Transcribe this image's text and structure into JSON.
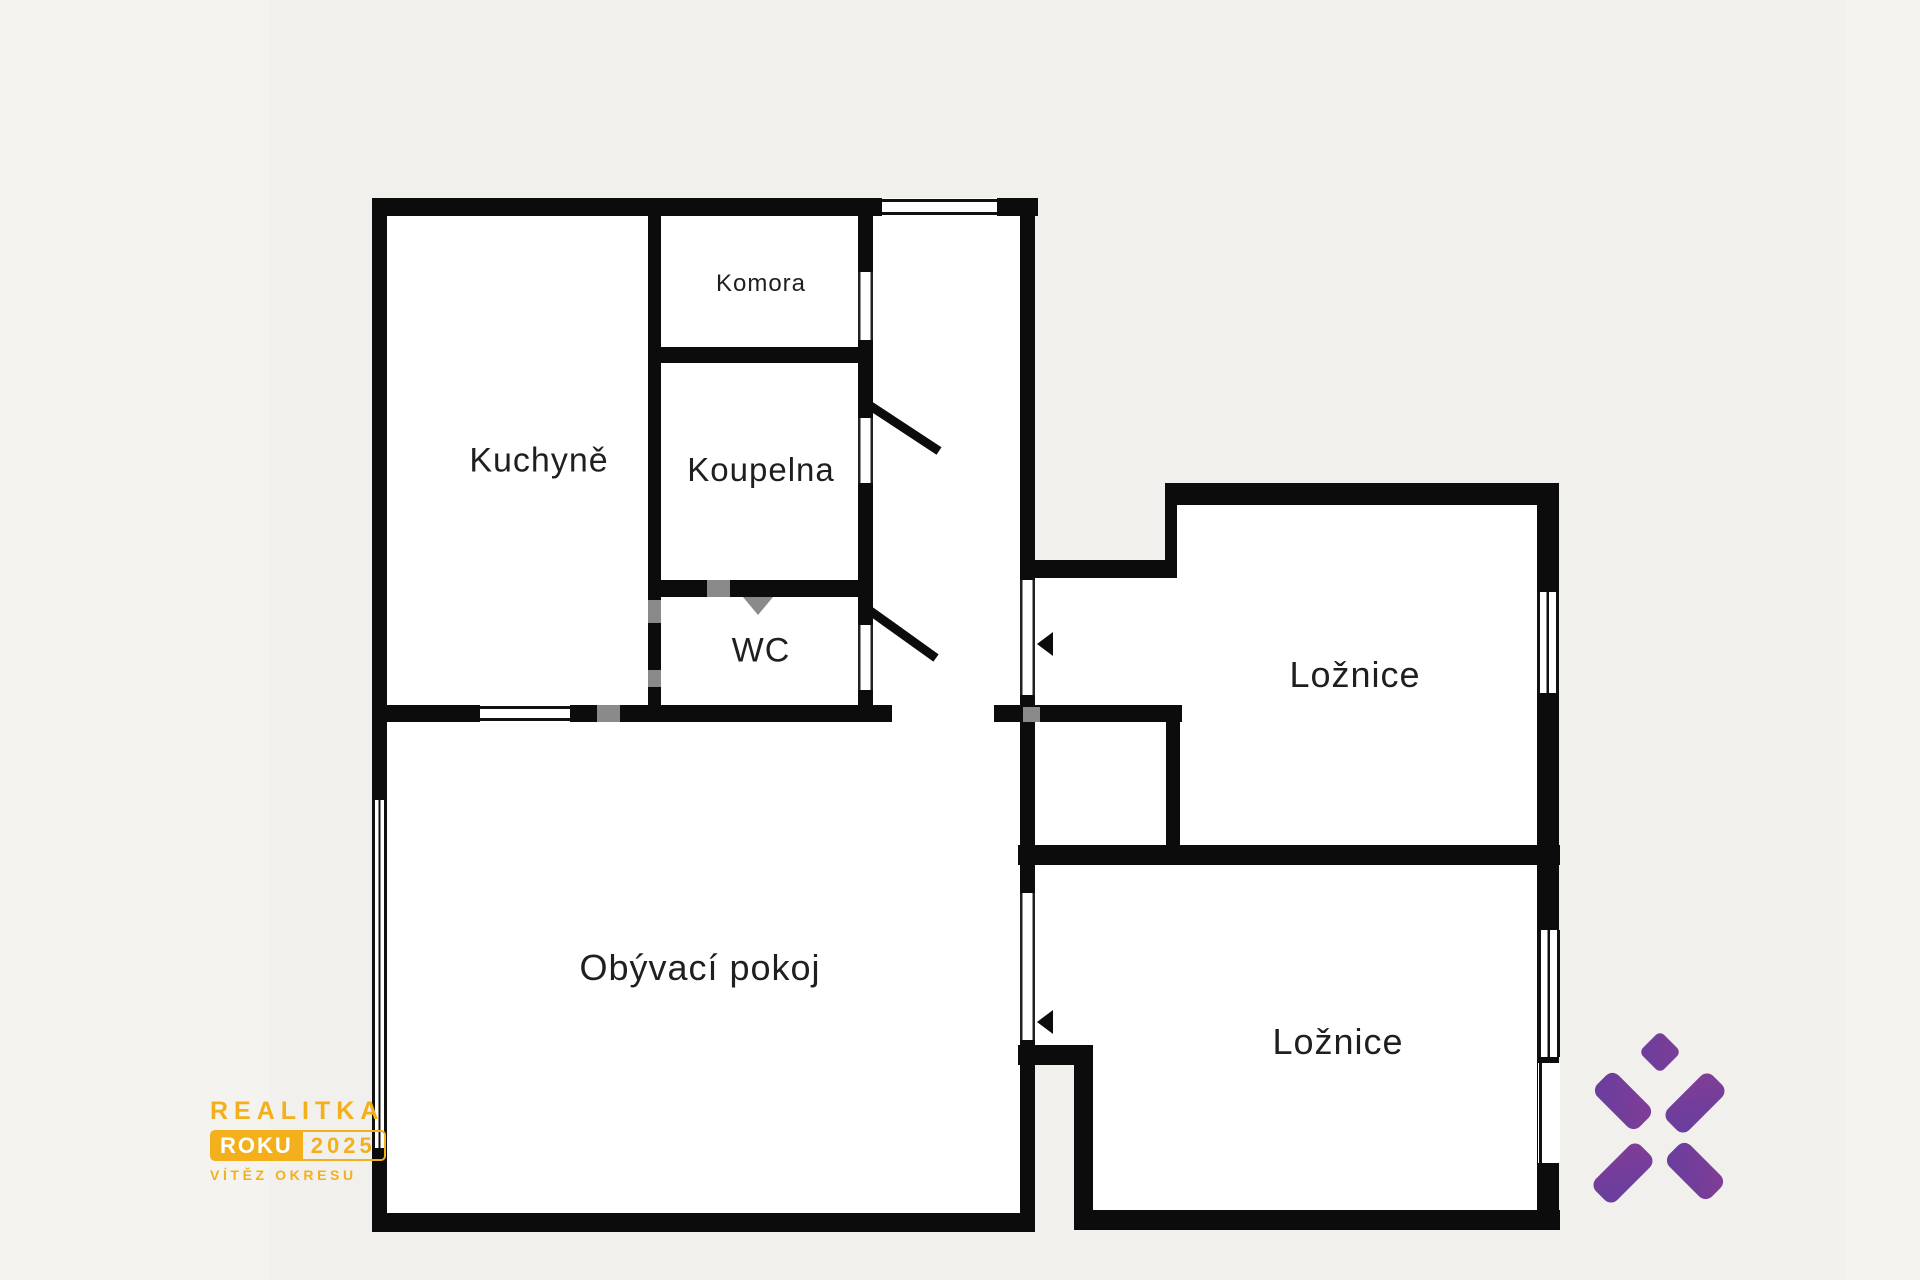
{
  "page": {
    "background_color": "#f4f3f0",
    "photo_area_color": "#f1f0ed"
  },
  "floor_plan": {
    "type": "apartment-floor-plan",
    "wall_color": "#0c0c0c",
    "room_fill_color": "#ffffff",
    "rooms": [
      {
        "id": "kuchyne",
        "label": "Kuchyně"
      },
      {
        "id": "komora",
        "label": "Komora"
      },
      {
        "id": "koupelna",
        "label": "Koupelna"
      },
      {
        "id": "wc",
        "label": "WC"
      },
      {
        "id": "obyvaci-pokoj",
        "label": "Obývací pokoj"
      },
      {
        "id": "loznice-1",
        "label": "Ložnice"
      },
      {
        "id": "loznice-2",
        "label": "Ložnice"
      }
    ]
  },
  "award_badge": {
    "line1": "REALITKA",
    "badge": "ROKU",
    "year": "2025",
    "line3": "VÍTĚZ OKRESU",
    "accent_color": "#f3b01c",
    "badge_text_color": "#ffffff"
  },
  "brand_logo": {
    "icon": "x-asterisk-icon",
    "gradient_start": "#3a3fae",
    "gradient_end": "#9b3c8d"
  }
}
